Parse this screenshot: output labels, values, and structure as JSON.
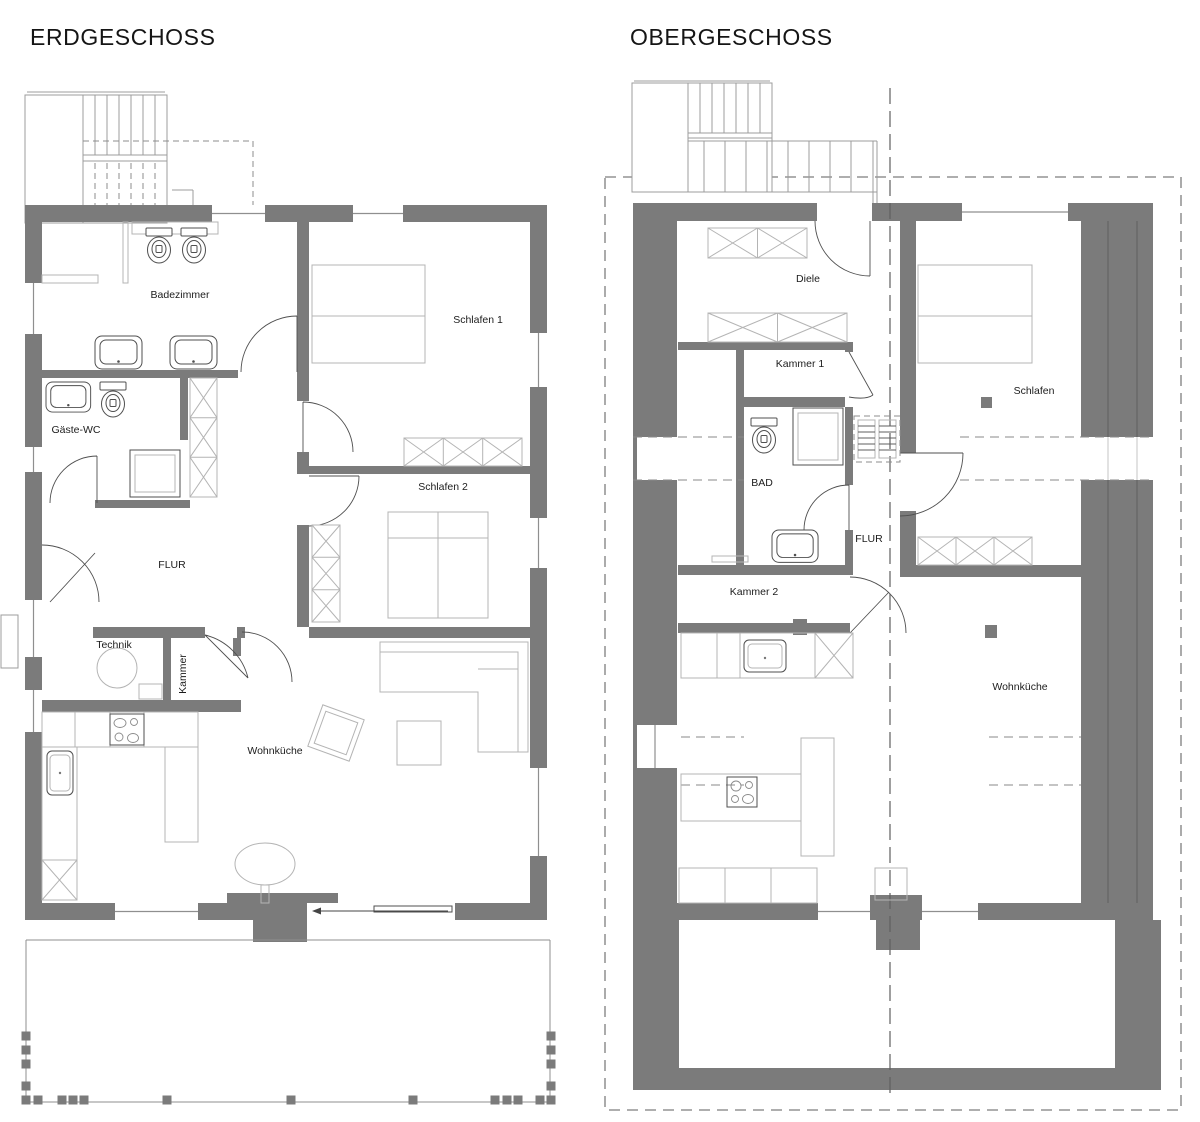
{
  "page": {
    "background": "#ffffff",
    "type": "architectural-floor-plan"
  },
  "floors": [
    {
      "title": "ERDGESCHOSS",
      "rooms": [
        {
          "label": "Badezimmer"
        },
        {
          "label": "Gäste-WC"
        },
        {
          "label": "Schlafen 1"
        },
        {
          "label": "Schlafen 2"
        },
        {
          "label": "FLUR"
        },
        {
          "label": "Technik"
        },
        {
          "label": "Kammer"
        },
        {
          "label": "Wohnküche"
        }
      ]
    },
    {
      "title": "OBERGESCHOSS",
      "rooms": [
        {
          "label": "Diele"
        },
        {
          "label": "Kammer 1"
        },
        {
          "label": "BAD"
        },
        {
          "label": "FLUR"
        },
        {
          "label": "Kammer 2"
        },
        {
          "label": "Schlafen"
        },
        {
          "label": "Wohnküche"
        }
      ]
    }
  ],
  "colors": {
    "wall": "#7b7b7b",
    "furniture_outline": "#b4b4b4",
    "fixture_outline": "#4f4f4f",
    "dashed_lines": "#8a8a8a",
    "text": "#1c1c1c",
    "background": "#ffffff"
  }
}
